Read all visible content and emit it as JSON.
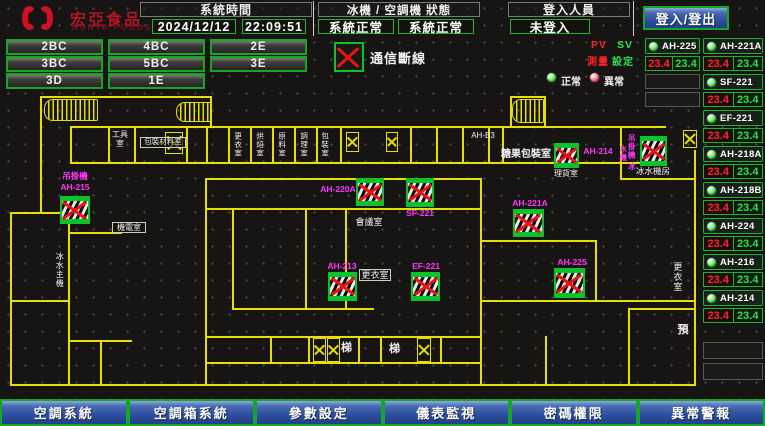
{
  "header": {
    "logo": {
      "title": "宏亞食品",
      "subtitle": "HUNYA FOODS"
    },
    "system_time": {
      "label": "系統時間",
      "date": "2024/12/12",
      "time": "22:09:51"
    },
    "status": {
      "label": "冰機 / 空調機 狀態",
      "chiller": "系統正常",
      "ac": "系統正常"
    },
    "login": {
      "label": "登入人員",
      "value": "未登入",
      "button": "登入/登出"
    }
  },
  "floor_buttons": [
    "2BC",
    "4BC",
    "2E",
    "3BC",
    "5BC",
    "3E",
    "3D",
    "1E"
  ],
  "legend": {
    "comm_loss": "通信斷線",
    "pv": "PV",
    "sv": "SV",
    "pv_caption": "測量",
    "sv_caption": "設定",
    "normal": "正常",
    "abnormal": "異常"
  },
  "panel": {
    "units": [
      {
        "name": "AH-225",
        "pv": "23.4",
        "sv": "23.4"
      },
      {
        "name": "AH-221A",
        "pv": "23.4",
        "sv": "23.4"
      },
      {
        "name": "SF-221",
        "pv": "23.4",
        "sv": "23.4"
      },
      {
        "name": "EF-221",
        "pv": "23.4",
        "sv": "23.4"
      },
      {
        "name": "AH-218A",
        "pv": "23.4",
        "sv": "23.4"
      },
      {
        "name": "AH-218B",
        "pv": "23.4",
        "sv": "23.4"
      },
      {
        "name": "AH-224",
        "pv": "23.4",
        "sv": "23.4"
      },
      {
        "name": "AH-216",
        "pv": "23.4",
        "sv": "23.4"
      },
      {
        "name": "AH-214",
        "pv": "23.4",
        "sv": "23.4"
      }
    ]
  },
  "map": {
    "devices": {
      "ah215": {
        "machine": "吊掛機",
        "name": "AH-215"
      },
      "ah220a": {
        "name": "AH-220A"
      },
      "sf221": {
        "name": "SF-221"
      },
      "ah213": {
        "name": "AH-213"
      },
      "ef221": {
        "name": "EF-221"
      },
      "ah214": {
        "name": "AH-214"
      },
      "hoist": {
        "name": "吊掛機 冰水機"
      },
      "ah221a": {
        "name": "AH-221A"
      },
      "ah225": {
        "name": "AH-225"
      }
    },
    "rooms": {
      "tool": "工具室",
      "storage": "包裝材料室",
      "v1": "更衣室",
      "v2": "烘焙室",
      "v3": "原料室",
      "v4": "調理室",
      "v5": "包裝室",
      "ahb3": "AH-B3",
      "candy": "糖果包裝室",
      "sorting": "理貨室",
      "chiller_room": "冰水機房",
      "meeting": "會議室",
      "locker_a": "更衣室",
      "locker_b": "更衣室",
      "reserve": "預",
      "stair_a": "梯",
      "stair_b": "梯",
      "chiller_main": "冰水主機",
      "mech": "機電室"
    }
  },
  "bottom_buttons": [
    "空調系統",
    "空調箱系統",
    "參數設定",
    "儀表監視",
    "密碼權限",
    "異常警報"
  ]
}
